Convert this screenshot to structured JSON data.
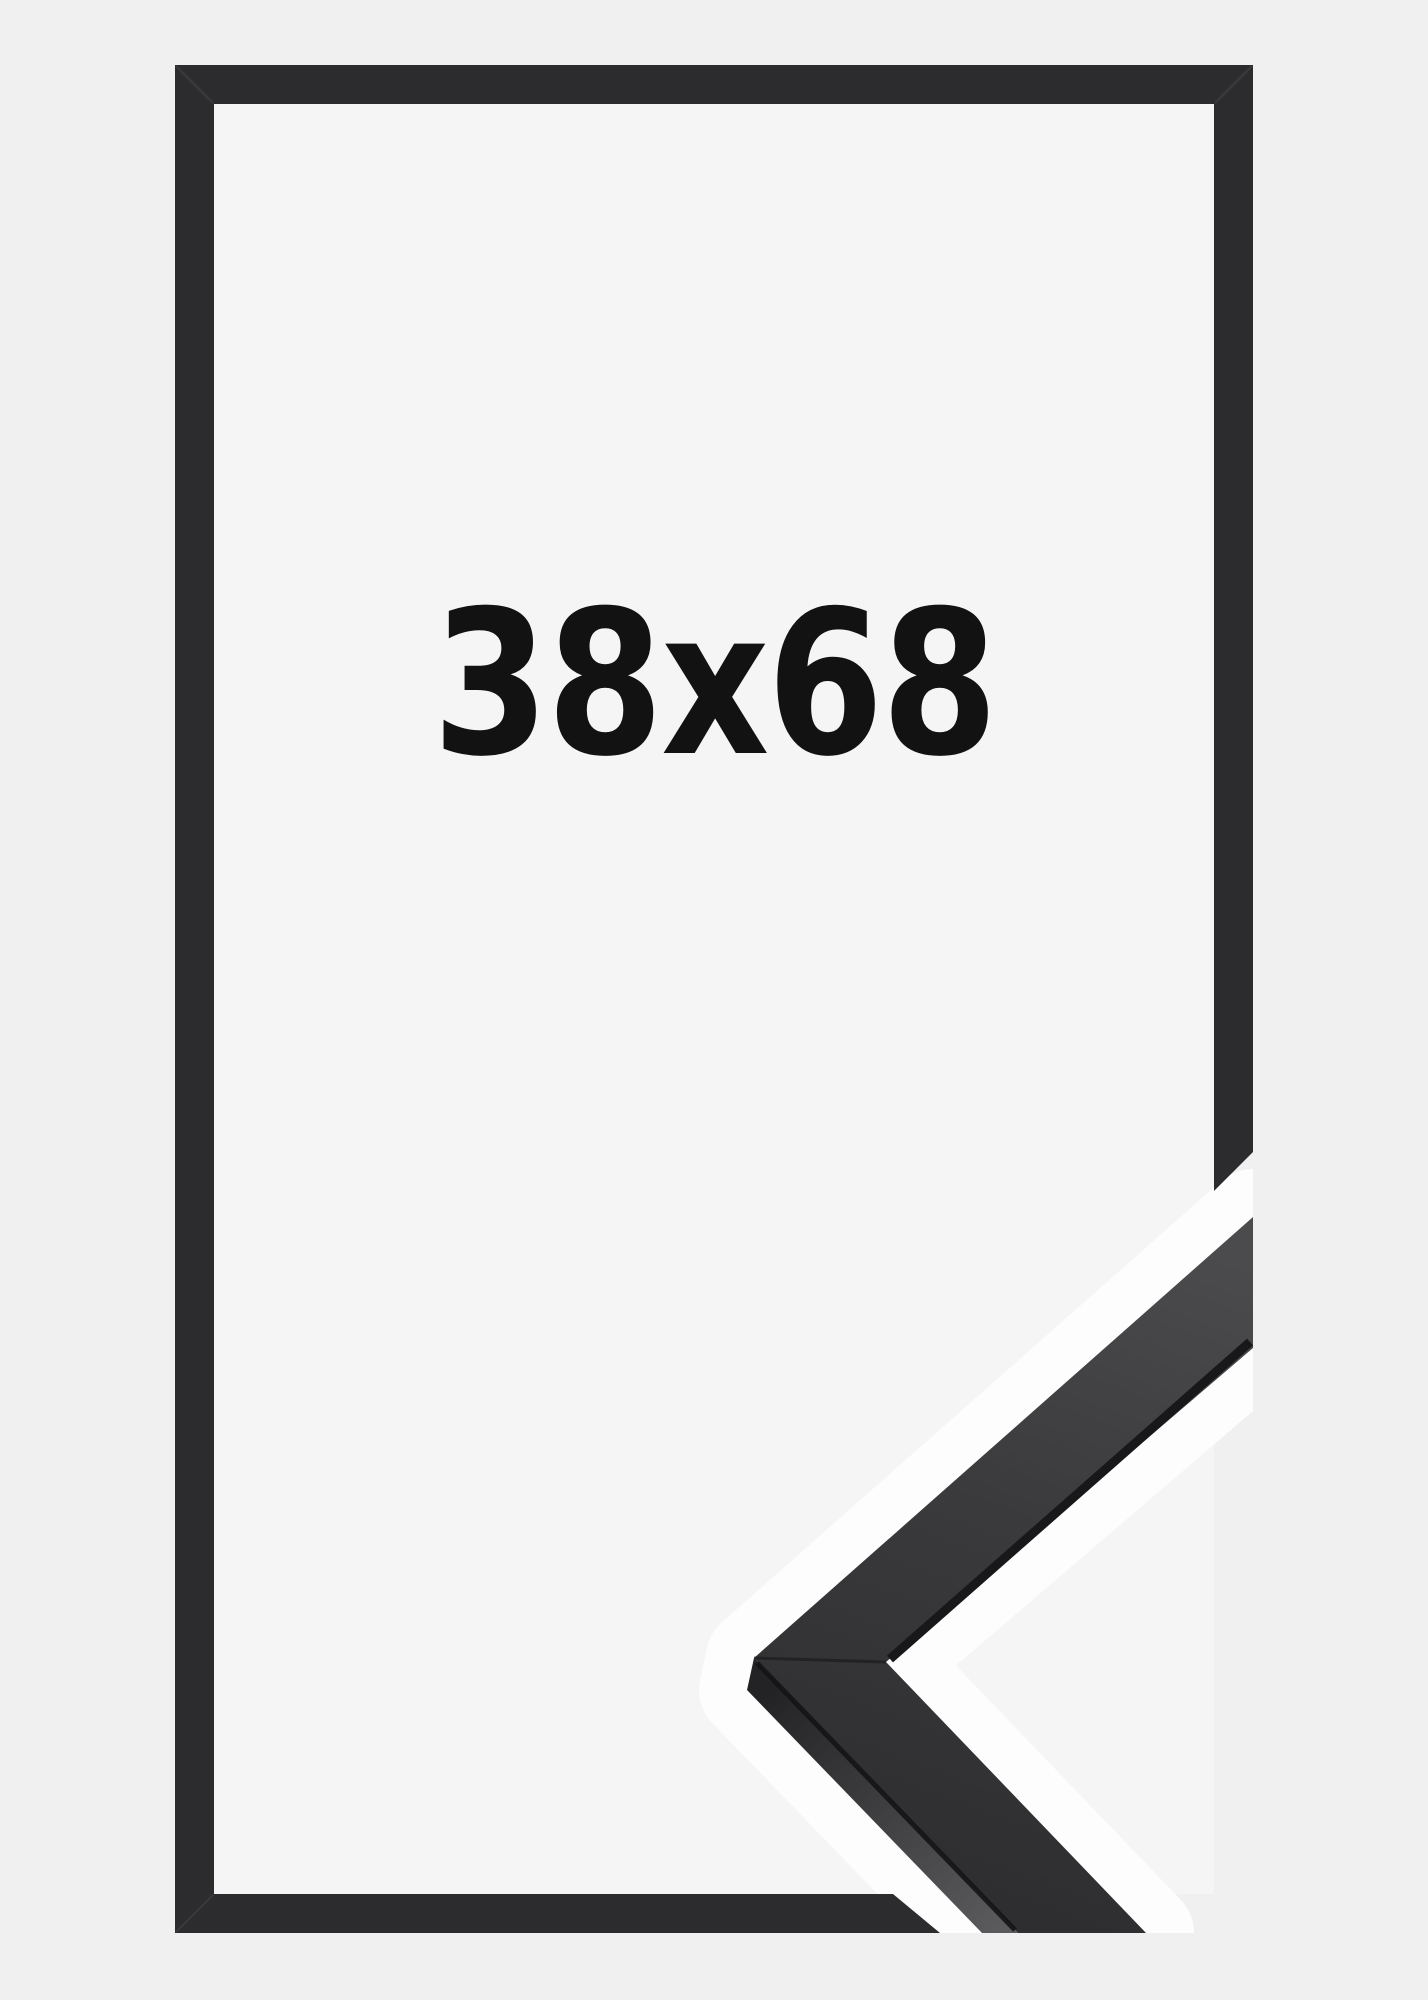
{
  "product_image": {
    "size_label": "38x68",
    "description_of_subject": "black picture frame outline with photographed corner sample of the moulding"
  },
  "theme": {
    "bg": "#f0f0f1",
    "bg_inner": "#f5f5f6",
    "bar": "#2c2c2e",
    "text": "#121212",
    "halo": "#fdfdfd",
    "face_hi": "#4b4b4d",
    "face_mid": "#3a3a3c",
    "face_lo": "#2d2d2f",
    "side_dark": "#232325",
    "side_light": "#5a5a5c",
    "lip_line": "#18181a",
    "arris_line": "#141416",
    "seam_light": "rgba(255,255,255,0.07)",
    "seam_dark": "rgba(20,20,22,0.55)"
  }
}
